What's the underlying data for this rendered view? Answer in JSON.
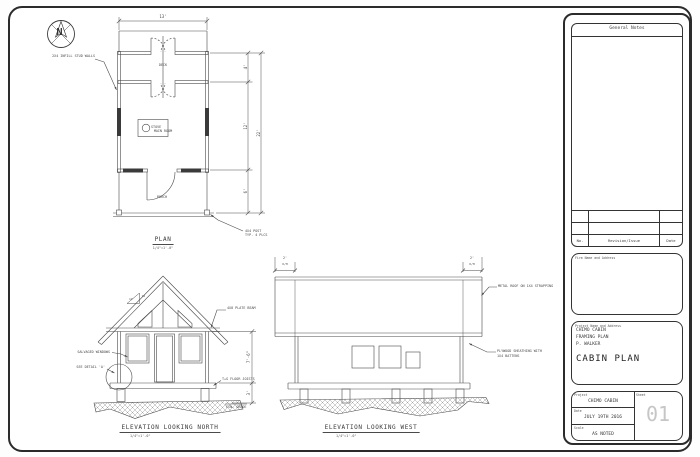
{
  "north_arrow": {
    "letter": "N"
  },
  "colors": {
    "line": "#4a4a4a",
    "sheet_number": "#c6c6c6"
  },
  "plan": {
    "title": "PLAN",
    "scale": "1/4\"=1'-0\"",
    "dim_width": "13'",
    "dim_deck": "4'",
    "dim_main": "12'",
    "dim_porch": "6'",
    "dim_overall": "22'",
    "note_walls": "2X4 INFILL STUD WALLS",
    "label_deck": "DECK",
    "label_stove": "STOVE",
    "label_main_room": "MAIN ROOM",
    "label_porch": "PORCH",
    "note_post_line1": "4X4 POST",
    "note_post_line2": "TYP. 4 PLCS"
  },
  "elevation_north": {
    "title": "ELEVATION LOOKING NORTH",
    "scale": "1/4\"=1'-0\"",
    "note_plate_beam": "4X8 PLATE BEAM",
    "note_windows": "SALVAGED WINDOWS",
    "note_detail": "SEE DETAIL 'A'",
    "note_floor": "T+G FLOOR JOISTS",
    "note_grade": "FIN. GRADE",
    "pitch_rise": "12",
    "pitch_run": "12",
    "dim_wall": "7'-6\"",
    "dim_under": "3'"
  },
  "elevation_west": {
    "title": "ELEVATION LOOKING WEST",
    "scale": "1/4\"=1'-0\"",
    "dim_overhang_left": "2'",
    "dim_overhang_right": "2'",
    "overhang_label": "O/H",
    "note_roof": "METAL ROOF ON 1X4 STRAPPING",
    "note_sheathing_line1": "PLYWOOD SHEATHING WITH",
    "note_sheathing_line2": "1X4 BATTENS"
  },
  "title_block": {
    "general_notes_title": "General Notes",
    "revision_headers": {
      "no": "No.",
      "revision": "Revision/Issue",
      "date": "Date"
    },
    "firm_label": "Firm Name and Address",
    "project_label": "Project Name and Address",
    "project_line1": "CHIMO CABIN",
    "project_line2": "FRAMING PLAN",
    "project_line3": "P. WALKER",
    "drawing_title": "CABIN PLAN",
    "field_project_label": "Project",
    "field_project_value": "CHIMO CABIN",
    "field_date_label": "Date",
    "field_date_value": "JULY 19TH 2016",
    "field_scale_label": "Scale",
    "field_scale_value": "AS NOTED",
    "field_sheet_label": "Sheet",
    "field_sheet_value": "01"
  }
}
